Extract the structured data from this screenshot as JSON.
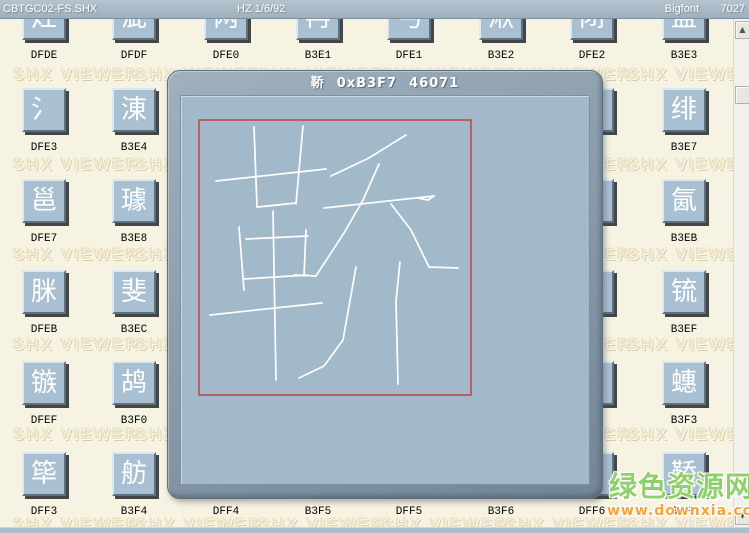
{
  "toolbar": {
    "file_name": "CBTGC02-FS.SHX",
    "encoding": "HZ 1/6/92",
    "font_type": "Bigfont",
    "glyph_count": "7027"
  },
  "watermark": {
    "text": "SHX VIEWER"
  },
  "site_watermark": {
    "name": "绿色资源网",
    "url": "www.downxia.com"
  },
  "colors": {
    "background": "#f7f3e2",
    "tile_face": "#a9c0d2",
    "canvas": "#a1b9c8",
    "glyph_stroke": "#ffffff",
    "red_box": "#cc2626",
    "site_green": "#8ed069",
    "site_orange": "#f4a43c"
  },
  "icons": {
    "scroll_up": "▲",
    "scroll_down": "▼"
  },
  "grid": {
    "cols": 8,
    "rows": 6,
    "cells": [
      {
        "code": "DFDE",
        "glyph": "灶",
        "col": 0,
        "row": 0,
        "partial": true
      },
      {
        "code": "DFDF",
        "glyph": "泚",
        "col": 1,
        "row": 0,
        "partial": true
      },
      {
        "code": "DFE0",
        "glyph": "两",
        "col": 2,
        "row": 0,
        "partial": true
      },
      {
        "code": "B3E1",
        "glyph": "冉",
        "col": 3,
        "row": 0,
        "partial": true
      },
      {
        "code": "DFE1",
        "glyph": "丐",
        "col": 4,
        "row": 0,
        "partial": true
      },
      {
        "code": "B3E2",
        "glyph": "湫",
        "col": 5,
        "row": 0,
        "partial": true
      },
      {
        "code": "DFE2",
        "glyph": "闭",
        "col": 6,
        "row": 0,
        "partial": true
      },
      {
        "code": "B3E3",
        "glyph": "盅",
        "col": 7,
        "row": 0,
        "partial": true
      },
      {
        "code": "DFE3",
        "glyph": "氵",
        "col": 0,
        "row": 1
      },
      {
        "code": "B3E4",
        "glyph": "涷",
        "col": 1,
        "row": 1
      },
      {
        "code": "B3E7",
        "glyph": "绯",
        "col": 7,
        "row": 1
      },
      {
        "code": "DFE7",
        "glyph": "邕",
        "col": 0,
        "row": 2
      },
      {
        "code": "B3E8",
        "glyph": "璩",
        "col": 1,
        "row": 2
      },
      {
        "code": "B3EB",
        "glyph": "氤",
        "col": 7,
        "row": 2
      },
      {
        "code": "DFEB",
        "glyph": "脒",
        "col": 0,
        "row": 3
      },
      {
        "code": "B3EC",
        "glyph": "斐",
        "col": 1,
        "row": 3
      },
      {
        "code": "B3EF",
        "glyph": "锍",
        "col": 7,
        "row": 3
      },
      {
        "code": "DFEF",
        "glyph": "镞",
        "col": 0,
        "row": 4
      },
      {
        "code": "B3F0",
        "glyph": "鸪",
        "col": 1,
        "row": 4
      },
      {
        "code": "B3F3",
        "glyph": "蟪",
        "col": 7,
        "row": 4
      },
      {
        "code": "DFF3",
        "glyph": "筚",
        "col": 0,
        "row": 5
      },
      {
        "code": "B3F4",
        "glyph": "舫",
        "col": 1,
        "row": 5
      },
      {
        "code": "DFF4",
        "glyph": "",
        "col": 2,
        "row": 5
      },
      {
        "code": "B3F5",
        "glyph": "",
        "col": 3,
        "row": 5
      },
      {
        "code": "DFF5",
        "glyph": "",
        "col": 4,
        "row": 5
      },
      {
        "code": "B3F6",
        "glyph": "",
        "col": 5,
        "row": 5
      },
      {
        "code": "DFF6",
        "glyph": "",
        "col": 6,
        "row": 5
      },
      {
        "code": "B3F7",
        "glyph": "鞒",
        "col": 7,
        "row": 5
      }
    ],
    "fragments": [
      {
        "col": 6,
        "row": 1
      },
      {
        "col": 6,
        "row": 2
      },
      {
        "col": 6,
        "row": 3
      },
      {
        "col": 6,
        "row": 4
      }
    ]
  },
  "dialog": {
    "character": "鞒",
    "code_hex": "0xB3F7",
    "code_decimal": "46071",
    "preview": {
      "red_box": [
        18,
        24,
        272,
        275
      ],
      "strokes": [
        [
          [
            73,
            31
          ],
          [
            76,
            111
          ]
        ],
        [
          [
            122,
            30
          ],
          [
            115,
            108
          ]
        ],
        [
          [
            35,
            85
          ],
          [
            145,
            73
          ]
        ],
        [
          [
            77,
            111
          ],
          [
            115,
            107
          ]
        ],
        [
          [
            58,
            131
          ],
          [
            63,
            194
          ]
        ],
        [
          [
            65,
            143
          ],
          [
            127,
            140
          ]
        ],
        [
          [
            125,
            134
          ],
          [
            123,
            180
          ]
        ],
        [
          [
            63,
            183
          ],
          [
            126,
            179
          ]
        ],
        [
          [
            29,
            219
          ],
          [
            141,
            207
          ]
        ],
        [
          [
            92,
            115
          ],
          [
            95,
            284
          ]
        ],
        [
          [
            150,
            80
          ],
          [
            188,
            62
          ],
          [
            225,
            39
          ]
        ],
        [
          [
            143,
            112
          ],
          [
            253,
            100
          ]
        ],
        [
          [
            253,
            100
          ],
          [
            247,
            104
          ],
          [
            237,
            102
          ]
        ],
        [
          [
            198,
            68
          ],
          [
            182,
            104
          ],
          [
            163,
            137
          ],
          [
            135,
            180
          ],
          [
            113,
            179
          ]
        ],
        [
          [
            210,
            108
          ],
          [
            230,
            134
          ],
          [
            248,
            171
          ],
          [
            277,
            172
          ]
        ],
        [
          [
            175,
            171
          ],
          [
            162,
            244
          ],
          [
            143,
            270
          ],
          [
            118,
            282
          ]
        ],
        [
          [
            219,
            166
          ],
          [
            215,
            205
          ],
          [
            217,
            288
          ]
        ]
      ]
    }
  }
}
